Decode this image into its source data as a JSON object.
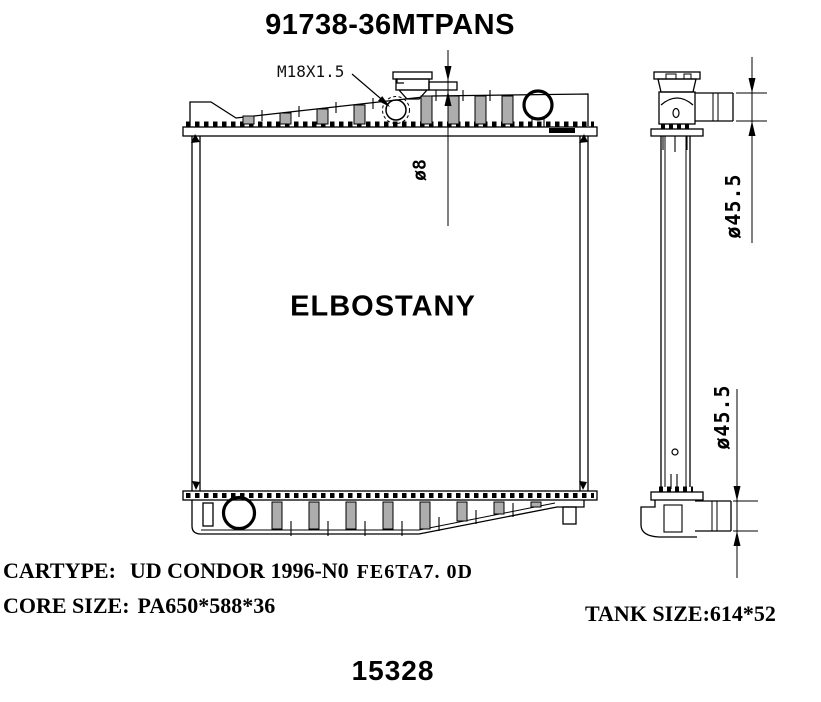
{
  "title": "91738-36MTPANS",
  "front_view": {
    "thread_label": "M18X1.5",
    "overflow_dia_label": "ø8",
    "brand_watermark": "ELBOSTANY"
  },
  "side_view": {
    "inlet_dia_label": "ø45.5",
    "outlet_dia_label": "ø45.5"
  },
  "specs": {
    "cartype_label": "CARTYPE:",
    "cartype_value": "UD CONDOR 1996-N0",
    "cartype_engine": "FE6TA7. 0D",
    "core_size_label": "CORE SIZE:",
    "core_size_value": "PA650*588*36",
    "tank_size_label": "TANK SIZE:",
    "tank_size_value": "614*52"
  },
  "footer": {
    "part_code": "15328"
  },
  "colors": {
    "line": "#000000",
    "background": "#ffffff"
  }
}
